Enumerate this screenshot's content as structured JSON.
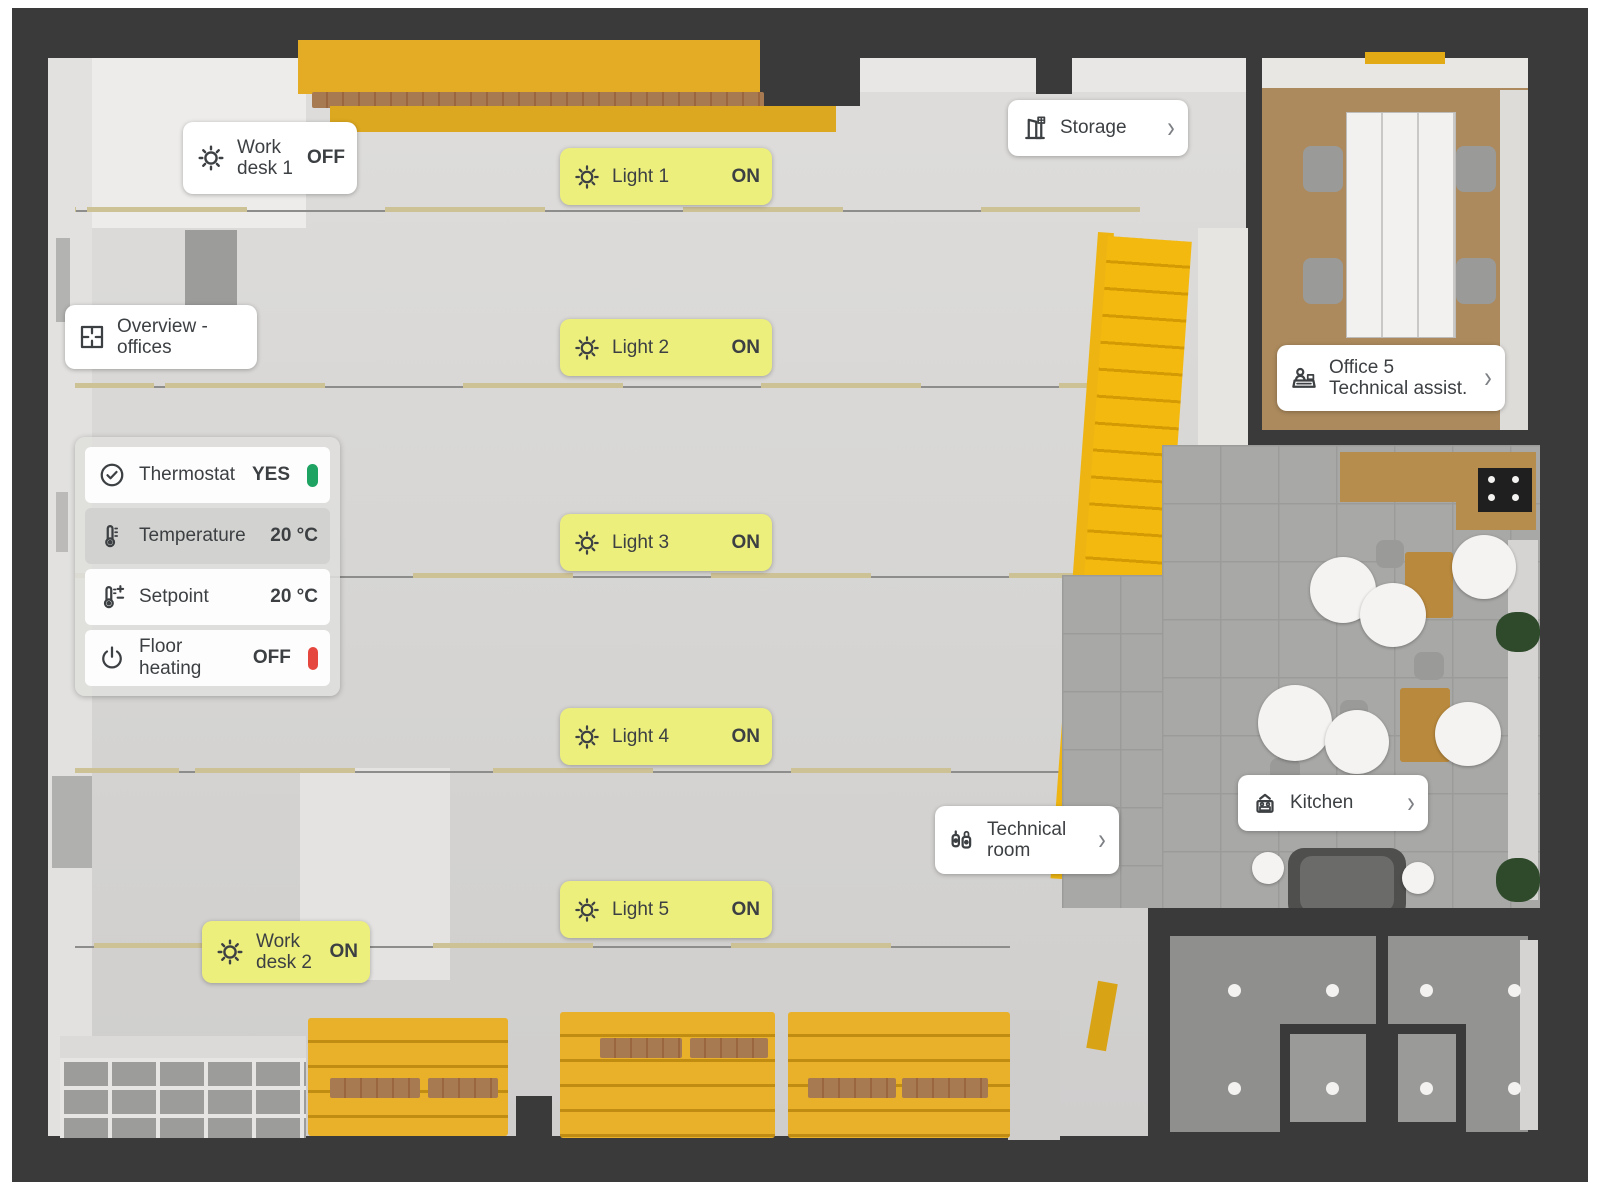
{
  "colors": {
    "accent_yellow": "#EDEF7D",
    "status_on_green": "#1EA362",
    "status_off_red": "#E5473E",
    "stairs_yellow": "#F4B90F",
    "wall_dark": "#3A3A3A",
    "text_dark": "#3D4043"
  },
  "cards": {
    "work_desk_1": {
      "line1": "Work",
      "line2": "desk 1",
      "value": "OFF"
    },
    "storage": {
      "label": "Storage",
      "chevron": "›"
    },
    "overview": {
      "line1": "Overview -",
      "line2": "offices"
    },
    "office5": {
      "line1": "Office 5",
      "line2": "Technical assist.",
      "chevron": "›"
    },
    "kitchen": {
      "label": "Kitchen",
      "chevron": "›"
    },
    "technical_room": {
      "line1": "Technical",
      "line2": "room",
      "chevron": "›"
    },
    "work_desk_2": {
      "line1": "Work",
      "line2": "desk 2",
      "value": "ON"
    }
  },
  "lights": [
    {
      "label": "Light 1",
      "value": "ON"
    },
    {
      "label": "Light 2",
      "value": "ON"
    },
    {
      "label": "Light 3",
      "value": "ON"
    },
    {
      "label": "Light 4",
      "value": "ON"
    },
    {
      "label": "Light 5",
      "value": "ON"
    }
  ],
  "thermostat_panel": {
    "rows": [
      {
        "label": "Thermostat",
        "value": "YES",
        "indicator": "green"
      },
      {
        "label": "Temperature",
        "value": "20 °C",
        "highlighted": true
      },
      {
        "label": "Setpoint",
        "value": "20 °C"
      },
      {
        "label": "Floor heating",
        "value": "OFF",
        "indicator": "red"
      }
    ]
  }
}
